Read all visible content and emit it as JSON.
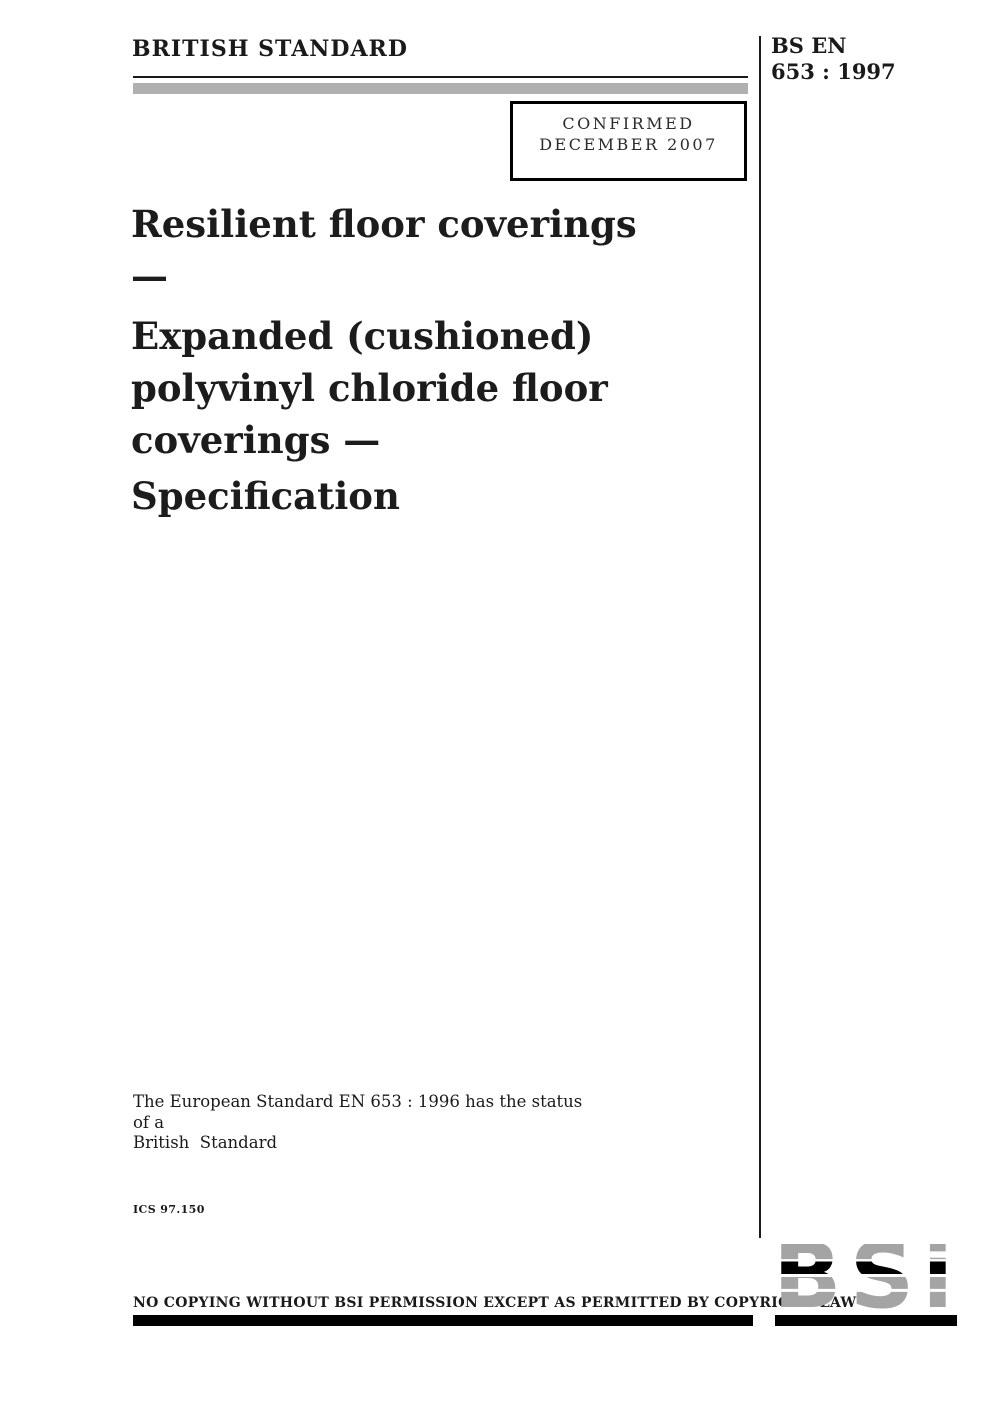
{
  "header": {
    "left_title": "BRITISH STANDARD",
    "code_line1": "BS EN",
    "code_line2": "653 : 1997"
  },
  "confirmed_box": {
    "line1": "CONFIRMED",
    "line2": "DECEMBER 2007"
  },
  "title": {
    "para1_line1": "Resilient floor coverings —",
    "para2_line1": "Expanded (cushioned)",
    "para2_line2": "polyvinyl chloride floor",
    "para2_line3": "coverings —",
    "para3_line1": "Specification"
  },
  "status_note": {
    "line1": "The European Standard EN 653 : 1996 has the status of a",
    "line2": "British  Standard"
  },
  "ics_code": "ICS 97.150",
  "footer": {
    "copyright_notice": "NO COPYING WITHOUT BSI PERMISSION EXCEPT AS PERMITTED BY COPYRIGHT LAW"
  },
  "logo": {
    "text": "BSi"
  },
  "colors": {
    "gray_bar": "#b0b0b0",
    "logo_gray": "#a4a4a4",
    "black": "#000000"
  }
}
